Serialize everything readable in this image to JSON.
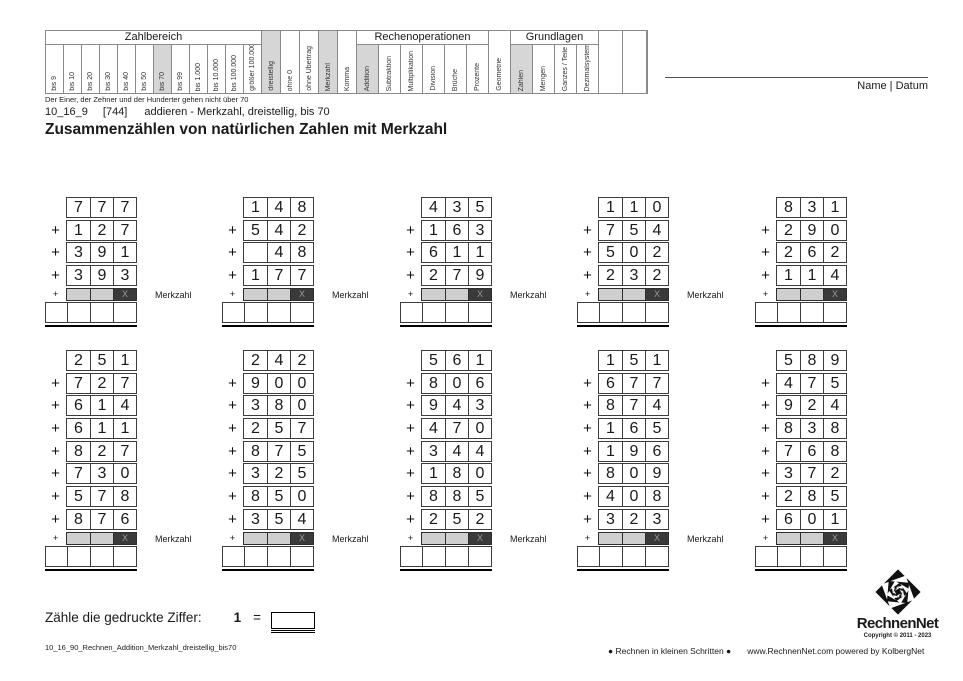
{
  "page": {
    "note_under_table": "Der Einer, der Zehner und der Hunderter gehen nicht über 70",
    "subtitle": {
      "code": "10_16_9",
      "ref": "[744]",
      "desc": "addieren - Merkzahl, dreistellig, bis 70"
    },
    "title": "Zusammenzählen von natürlichen Zahlen mit Merkzahl",
    "name_datum": "Name | Datum"
  },
  "colors": {
    "shaded_cell": "#d6d6d6",
    "merkzahl_light_cell": "#cfcfcf",
    "merkzahl_dark_cell": "#3a3a3a",
    "border": "#8a8a8a"
  },
  "topic_matrix": {
    "columns": [
      {
        "label": "bis 9",
        "group": "Zahlbereich",
        "checked": false
      },
      {
        "label": "bis 10",
        "group": "Zahlbereich",
        "checked": false
      },
      {
        "label": "bis 20",
        "group": "Zahlbereich",
        "checked": false
      },
      {
        "label": "bis 30",
        "group": "Zahlbereich",
        "checked": false
      },
      {
        "label": "bis 40",
        "group": "Zahlbereich",
        "checked": false
      },
      {
        "label": "bis 50",
        "group": "Zahlbereich",
        "checked": false
      },
      {
        "label": "bis 70",
        "group": "Zahlbereich",
        "checked": true
      },
      {
        "label": "bis 99",
        "group": "Zahlbereich",
        "checked": false
      },
      {
        "label": "bis 1.000",
        "group": "Zahlbereich",
        "checked": false
      },
      {
        "label": "bis 10.000",
        "group": "Zahlbereich",
        "checked": false
      },
      {
        "label": "bis 100.000",
        "group": "Zahlbereich",
        "checked": false
      },
      {
        "label": "größer 100.000",
        "group": "Zahlbereich",
        "checked": false
      },
      {
        "label": "dreistellig",
        "group": null,
        "checked": true
      },
      {
        "label": "ohne 0",
        "group": null,
        "checked": false
      },
      {
        "label": "ohne Übertrag",
        "group": null,
        "checked": false
      },
      {
        "label": "Merkzahl",
        "group": null,
        "checked": true
      },
      {
        "label": "Komma",
        "group": null,
        "checked": false
      },
      {
        "label": "Addition",
        "group": "Rechenoperationen",
        "checked": true
      },
      {
        "label": "Subtraktion",
        "group": "Rechenoperationen",
        "checked": false
      },
      {
        "label": "Multiplikation",
        "group": "Rechenoperationen",
        "checked": false
      },
      {
        "label": "Division",
        "group": "Rechenoperationen",
        "checked": false
      },
      {
        "label": "Brüche",
        "group": "Rechenoperationen",
        "checked": false
      },
      {
        "label": "Prozente",
        "group": "Rechenoperationen",
        "checked": false
      },
      {
        "label": "Geometrie",
        "group": null,
        "checked": false
      },
      {
        "label": "Zahlen",
        "group": "Grundlagen",
        "checked": true
      },
      {
        "label": "Mengen",
        "group": "Grundlagen",
        "checked": false
      },
      {
        "label": "Ganzes / Teile",
        "group": "Grundlagen",
        "checked": false
      },
      {
        "label": "Dezimalsystem",
        "group": "Grundlagen",
        "checked": false
      },
      {
        "label": "",
        "group": null,
        "checked": false
      },
      {
        "label": "",
        "group": null,
        "checked": false
      }
    ]
  },
  "problems": {
    "merkzahl_label": "Merkzahl",
    "merkzahl_x": "X",
    "plus_sign": "+",
    "rows": [
      {
        "blocks": [
          {
            "addends": [
              "777",
              "127",
              "391",
              "393"
            ]
          },
          {
            "addends": [
              "148",
              "542",
              " 48",
              "177"
            ]
          },
          {
            "addends": [
              "435",
              "163",
              "611",
              "279"
            ]
          },
          {
            "addends": [
              "110",
              "754",
              "502",
              "232"
            ]
          },
          {
            "addends": [
              "831",
              "290",
              "262",
              "114"
            ]
          }
        ]
      },
      {
        "blocks": [
          {
            "addends": [
              "251",
              "727",
              "614",
              "611",
              "827",
              "730",
              "578",
              "876"
            ]
          },
          {
            "addends": [
              "242",
              "900",
              "380",
              "257",
              "875",
              "325",
              "850",
              "354"
            ]
          },
          {
            "addends": [
              "561",
              "806",
              "943",
              "470",
              "344",
              "180",
              "885",
              "252"
            ]
          },
          {
            "addends": [
              "151",
              "677",
              "874",
              "165",
              "196",
              "809",
              "408",
              "323"
            ]
          },
          {
            "addends": [
              "589",
              "475",
              "924",
              "838",
              "768",
              "372",
              "285",
              "601"
            ]
          }
        ]
      }
    ]
  },
  "count_task": {
    "prompt": "Zähle die gedruckte Ziffer:",
    "digit": "1",
    "equals": "="
  },
  "footer": {
    "filename": "10_16_90_Rechnen_Addition_Merkzahl_dreistellig_bis70",
    "slogan": "● Rechnen in kleinen Schritten ●",
    "site": "www.RechnenNet.com powered by KolbergNet",
    "logo_text": "RechnenNet",
    "copyright": "Copyright © 2011 - 2023"
  }
}
